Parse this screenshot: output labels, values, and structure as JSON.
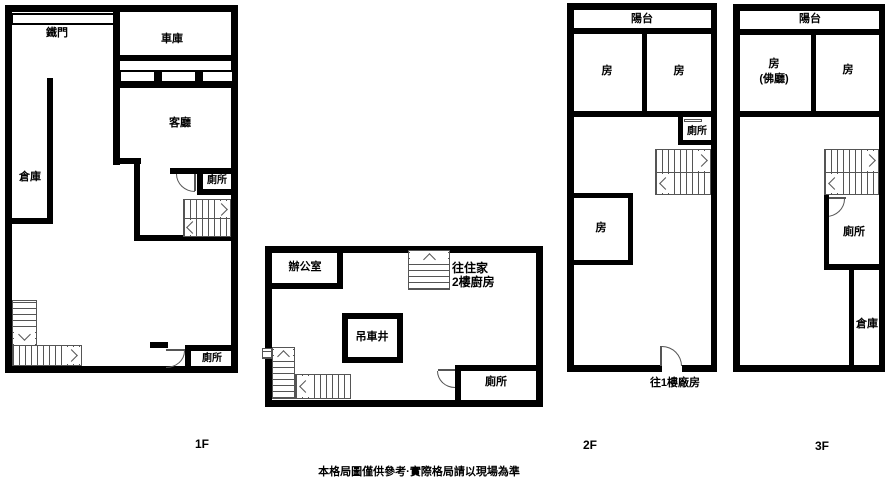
{
  "f1": {
    "label": "1F",
    "gate": "鐵門",
    "garage": "車庫",
    "living": "客廳",
    "storage": "倉庫",
    "toilet_upper": "廁所",
    "toilet_lower": "廁所"
  },
  "mid": {
    "office": "辦公室",
    "stair_note1": "往住家",
    "stair_note2": "2樓廚房",
    "crane_shaft": "吊車井",
    "toilet": "廁所"
  },
  "f2": {
    "label": "2F",
    "balcony": "陽台",
    "room_left": "房",
    "room_right": "房",
    "room_lower": "房",
    "toilet": "廁所",
    "exit_note": "往1樓廠房"
  },
  "f3": {
    "label": "3F",
    "balcony": "陽台",
    "room_left": "房",
    "room_left_sub": "(佛廳)",
    "room_right": "房",
    "toilet": "廁所",
    "storage": "倉庫"
  },
  "footer": {
    "disclaimer": "本格局圖僅供參考·實際格局請以現場為準"
  },
  "colors": {
    "wall": "#000000",
    "line": "#555555",
    "background": "#ffffff"
  }
}
